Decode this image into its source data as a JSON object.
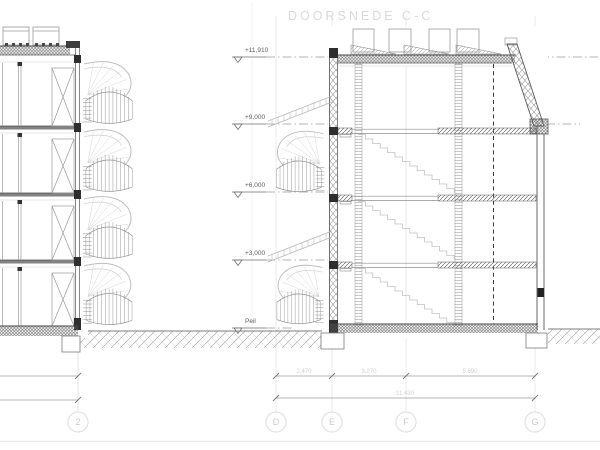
{
  "title": "DOORSNEDE C-C",
  "levels": [
    {
      "label": "+11,910"
    },
    {
      "label": "+9,000"
    },
    {
      "label": "+6,000"
    },
    {
      "label": "+3,000"
    },
    {
      "label": "Peil"
    }
  ],
  "dimensions": {
    "segments": [
      "2,470",
      "3,270",
      "5,690"
    ],
    "total": "11,430"
  },
  "grid": [
    "2",
    "D",
    "E",
    "F",
    "G"
  ],
  "colors": {
    "ink_dark": "#3f3f3f",
    "ink_mid": "#8a8a8a",
    "ink_light": "#c4c4c4",
    "faint": "#e4e4e4",
    "title_gray": "#d9d9d9"
  }
}
